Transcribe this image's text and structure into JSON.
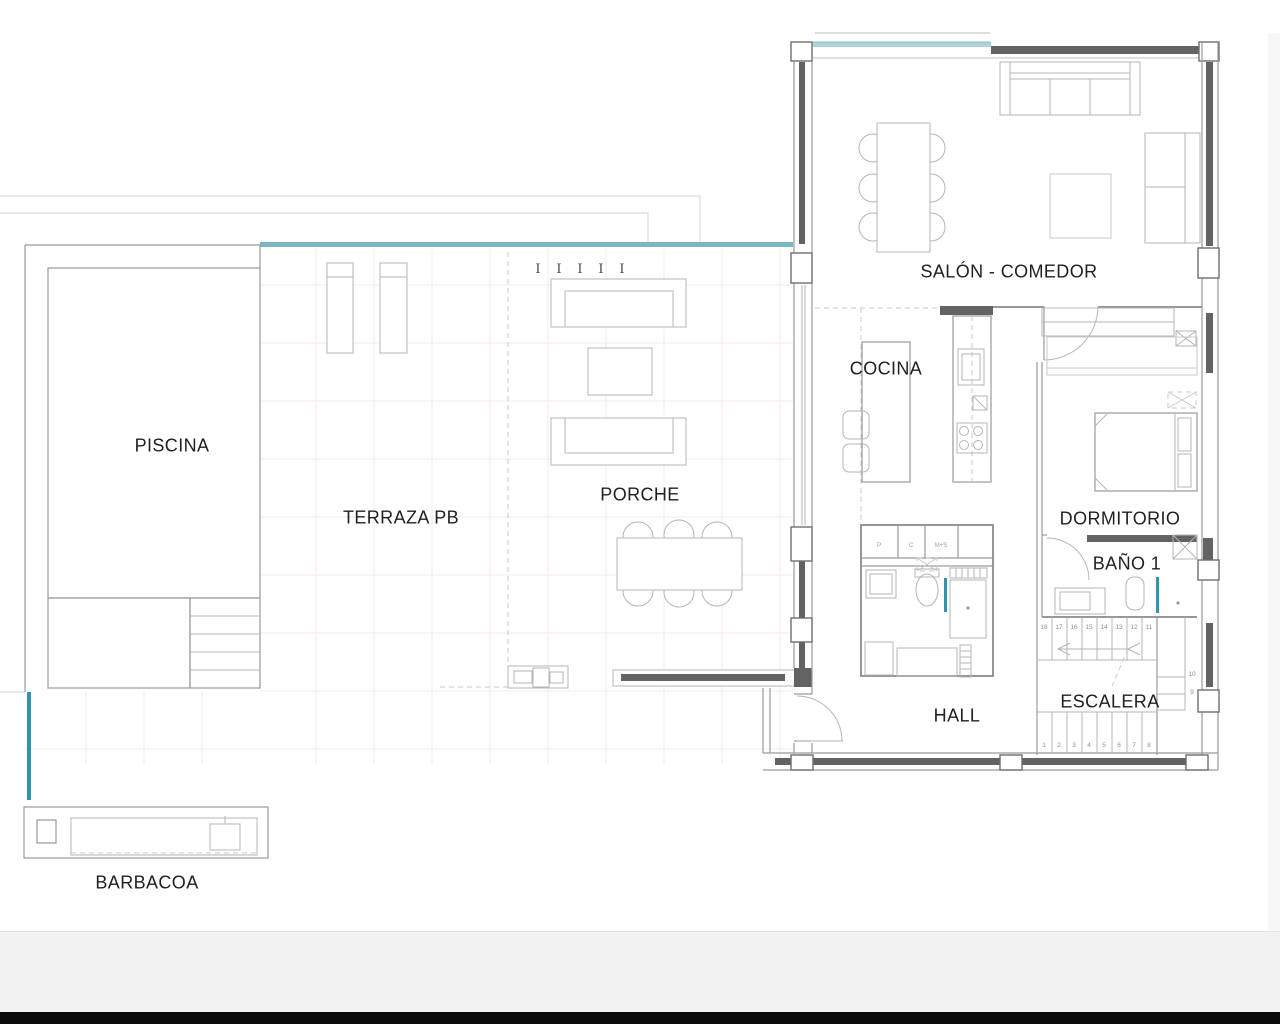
{
  "viewer": {
    "background": "#ffffff",
    "bottom_strip_color": "#f2f2f2",
    "bottom_bar_color": "#0b0b0b",
    "right_margin_color": "#f7f7f7"
  },
  "palette": {
    "accent_teal_band": "#7db6c3",
    "accent_teal_dark": "#2f95ad",
    "glass_blue": "#aed3dc",
    "wall_dark": "#636363",
    "wall_line": "#9a9a9a",
    "furniture_line": "#b5b5b5",
    "grid_line": "#f4ebe9",
    "label_color": "#1f1f1f",
    "number_color": "#8f8f8f"
  },
  "plan": {
    "rooms": [
      {
        "id": "piscina",
        "label": "PISCINA"
      },
      {
        "id": "terraza-pb",
        "label": "TERRAZA PB"
      },
      {
        "id": "porche",
        "label": "PORCHE"
      },
      {
        "id": "salon",
        "label": "SALÓN - COMEDOR"
      },
      {
        "id": "cocina",
        "label": "COCINA"
      },
      {
        "id": "dormitorio",
        "label": "DORMITORIO"
      },
      {
        "id": "bano1",
        "label": "BAÑO 1"
      },
      {
        "id": "hall",
        "label": "HALL"
      },
      {
        "id": "escalera",
        "label": "ESCALERA"
      },
      {
        "id": "barbacoa",
        "label": "BARBACOA"
      }
    ],
    "fixtures": {
      "utility_cabinets": [
        "P",
        "C",
        "M+S"
      ]
    },
    "stairs": {
      "upper_steps": [
        "18",
        "17",
        "16",
        "15",
        "14",
        "13",
        "12",
        "11"
      ],
      "side_steps": [
        "10",
        "9"
      ],
      "lower_steps": [
        "1",
        "2",
        "3",
        "4",
        "5",
        "6",
        "7",
        "8"
      ]
    },
    "column_mark": "I"
  }
}
